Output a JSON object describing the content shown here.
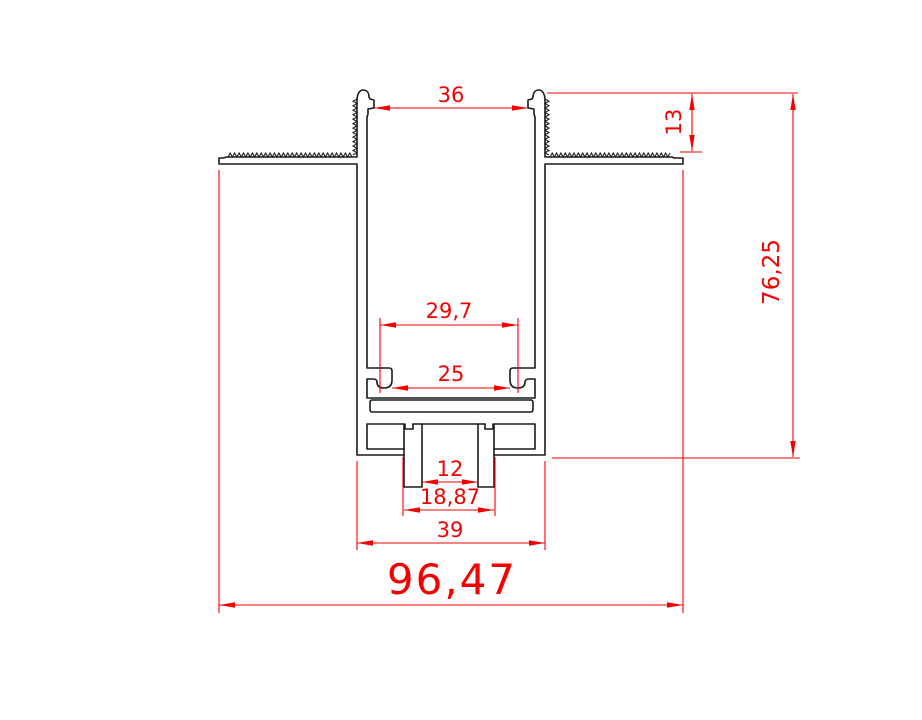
{
  "drawing": {
    "type": "technical-cross-section",
    "description": "Recessed aluminium LED profile cross-section with CAD dimension annotations",
    "units_style": "decimal-comma millimetres",
    "colors": {
      "background": "#ffffff",
      "geometry": "#1a1a1a",
      "dimensions": "#f40000"
    },
    "dimensions": {
      "top_opening_width": "36",
      "recess_depth": "13",
      "overall_height": "76,25",
      "inner_width": "29,7",
      "clip_span": "25",
      "slot_inner_width": "12",
      "slot_outer_width": "18,87",
      "body_width": "39",
      "overall_width": "96,47"
    }
  }
}
